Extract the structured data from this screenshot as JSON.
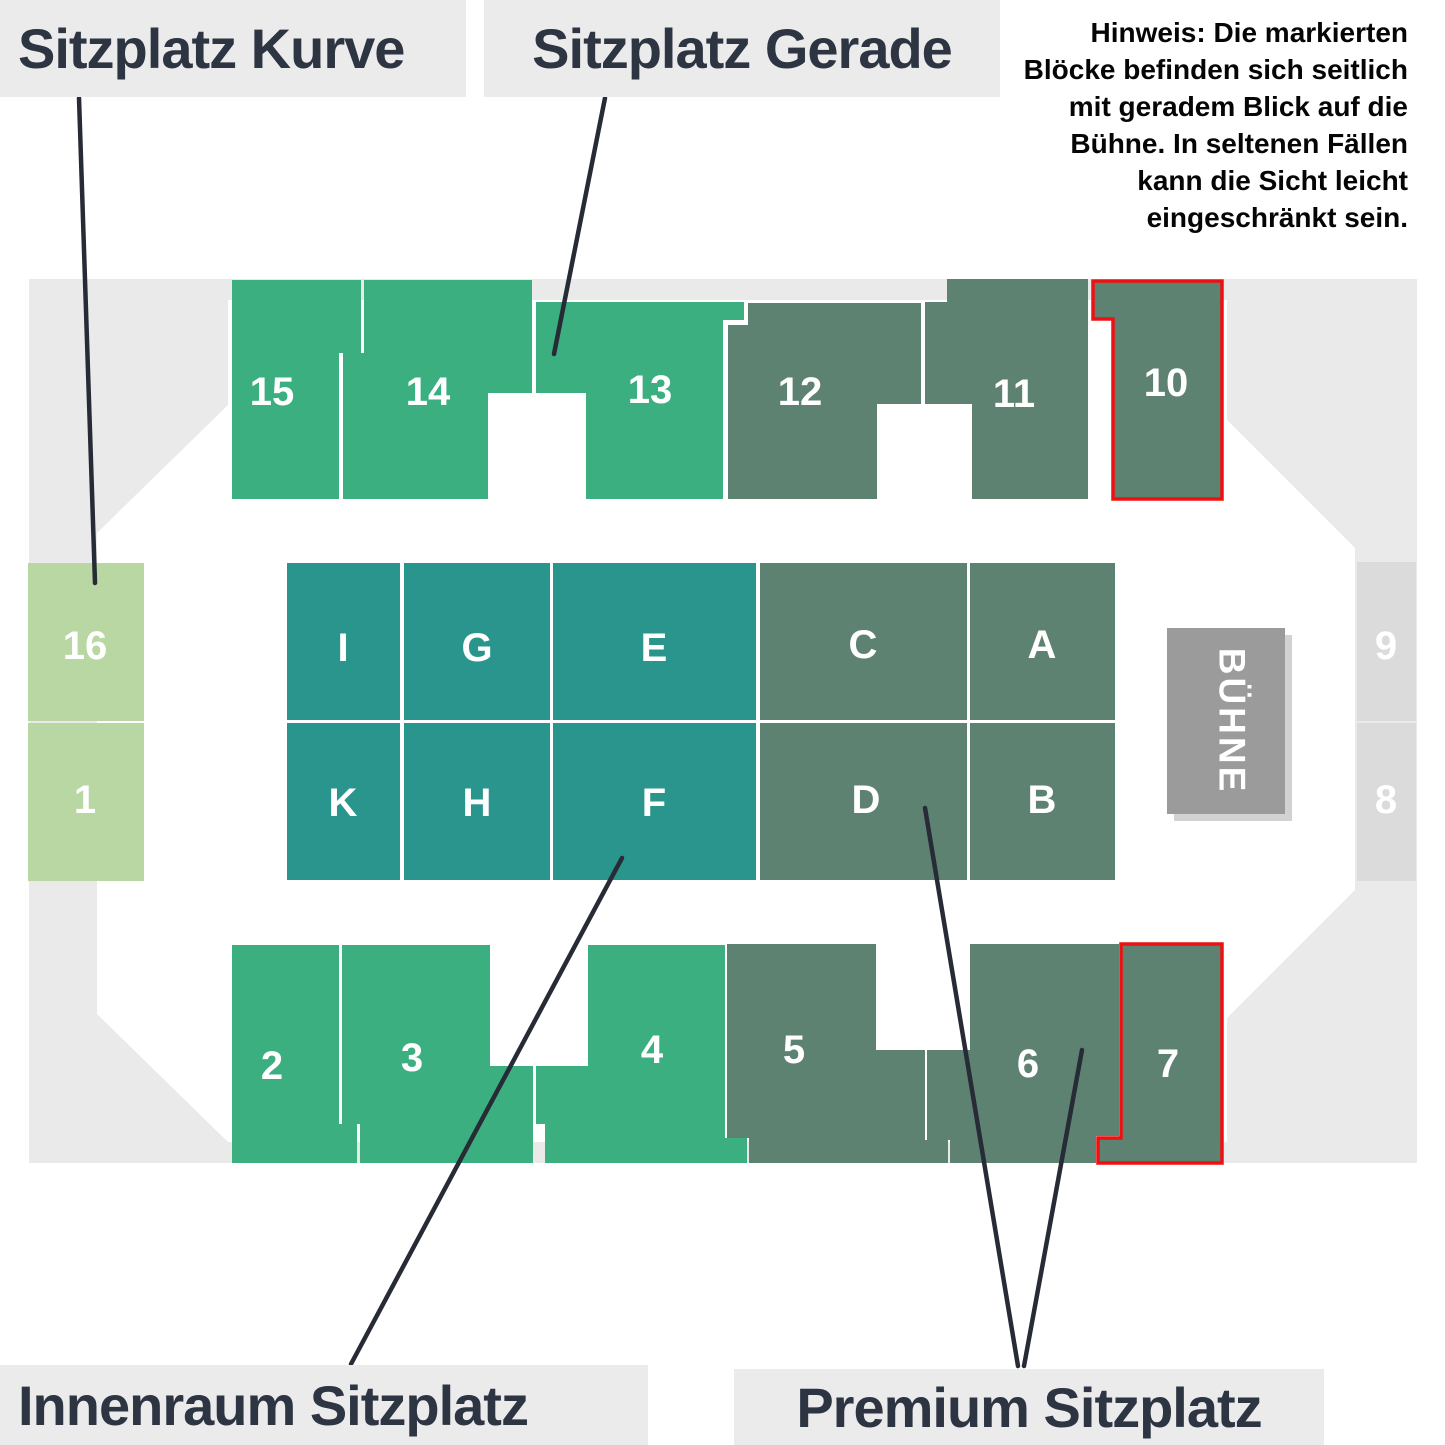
{
  "legend": {
    "kurve": "Sitzplatz Kurve",
    "gerade": "Sitzplatz Gerade",
    "innenraum": "Innenraum Sitzplatz",
    "premium": "Premium Sitzplatz"
  },
  "note": {
    "text": "Hinweis: Die markierten\nBlöcke befinden sich seitlich\nmit  geradem Blick auf die\nBühne. In seltenen Fällen\nkann die Sicht leicht\neingeschränkt sein."
  },
  "stage": {
    "label": "BÜHNE"
  },
  "colors": {
    "gerade": "#3CAF81",
    "premium": "#5D8272",
    "innenraum": "#2A958C",
    "kurve": "#B8D7A3",
    "side": "#DBDBDB",
    "stage": "#9B9B9B",
    "stageShadow": "#D2D2D2",
    "ring": "#EAEAEA",
    "marked": "#EE1111",
    "labelBg": "#EBEBEB",
    "labelText": "#2D3442",
    "noteText": "#050505",
    "line": "#262B35",
    "blockText": "#FFFFFF"
  },
  "blocks": [
    {
      "label": "15",
      "category": "gerade"
    },
    {
      "label": "14",
      "category": "gerade"
    },
    {
      "label": "13",
      "category": "gerade"
    },
    {
      "label": "12",
      "category": "premium"
    },
    {
      "label": "11",
      "category": "premium"
    },
    {
      "label": "10",
      "category": "premium",
      "marked": true
    },
    {
      "label": "16",
      "category": "kurve"
    },
    {
      "label": "1",
      "category": "kurve"
    },
    {
      "label": "I",
      "category": "innenraum"
    },
    {
      "label": "G",
      "category": "innenraum"
    },
    {
      "label": "E",
      "category": "innenraum"
    },
    {
      "label": "C",
      "category": "premium"
    },
    {
      "label": "A",
      "category": "premium"
    },
    {
      "label": "K",
      "category": "innenraum"
    },
    {
      "label": "H",
      "category": "innenraum"
    },
    {
      "label": "F",
      "category": "innenraum"
    },
    {
      "label": "D",
      "category": "premium"
    },
    {
      "label": "B",
      "category": "premium"
    },
    {
      "label": "9",
      "category": "side"
    },
    {
      "label": "8",
      "category": "side"
    },
    {
      "label": "2",
      "category": "gerade"
    },
    {
      "label": "3",
      "category": "gerade"
    },
    {
      "label": "4",
      "category": "gerade"
    },
    {
      "label": "5",
      "category": "premium"
    },
    {
      "label": "6",
      "category": "premium"
    },
    {
      "label": "7",
      "category": "premium",
      "marked": true
    }
  ]
}
